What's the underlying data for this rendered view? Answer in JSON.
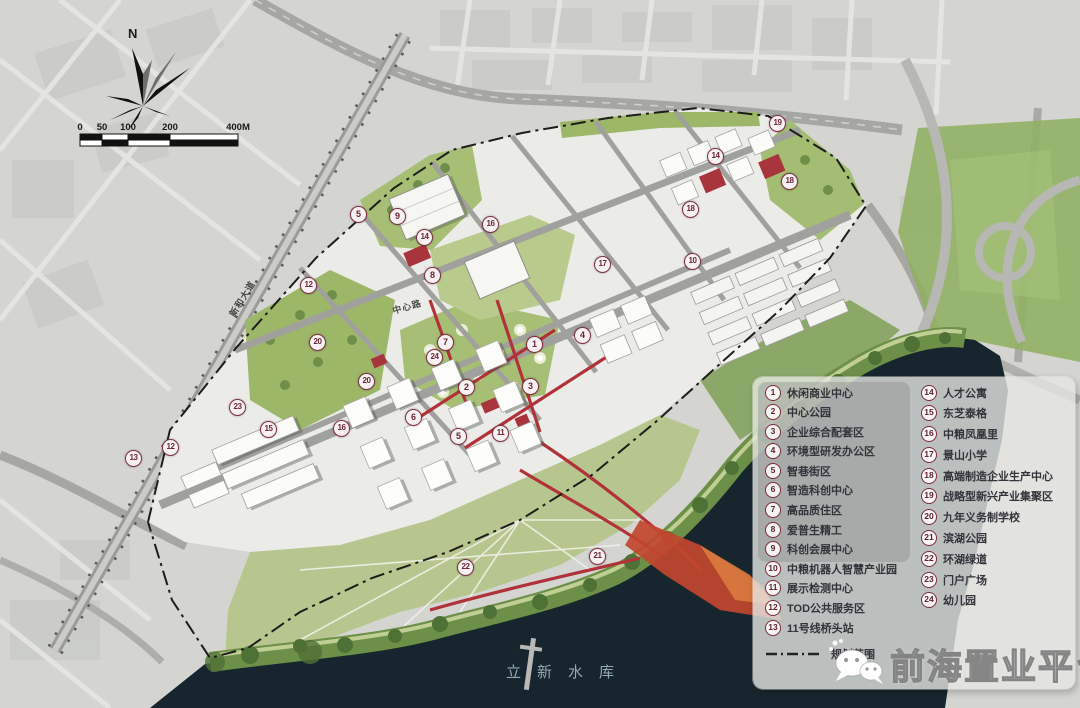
{
  "map": {
    "north_label": "N",
    "scale": {
      "labels": [
        "0",
        "50",
        "100",
        "200",
        "400M"
      ]
    },
    "water_label": "立新水库",
    "road_labels": [
      {
        "text": "新和大道"
      },
      {
        "text": "中心路"
      }
    ],
    "markers": [
      {
        "n": "5",
        "x": 358,
        "y": 214
      },
      {
        "n": "9",
        "x": 397,
        "y": 216
      },
      {
        "n": "14",
        "x": 424,
        "y": 237
      },
      {
        "n": "16",
        "x": 490,
        "y": 224
      },
      {
        "n": "8",
        "x": 432,
        "y": 275
      },
      {
        "n": "12",
        "x": 308,
        "y": 285
      },
      {
        "n": "20",
        "x": 317,
        "y": 342
      },
      {
        "n": "17",
        "x": 602,
        "y": 264
      },
      {
        "n": "18",
        "x": 690,
        "y": 209
      },
      {
        "n": "10",
        "x": 692,
        "y": 261
      },
      {
        "n": "14",
        "x": 715,
        "y": 156
      },
      {
        "n": "19",
        "x": 777,
        "y": 123
      },
      {
        "n": "18",
        "x": 789,
        "y": 181
      },
      {
        "n": "7",
        "x": 445,
        "y": 342
      },
      {
        "n": "24",
        "x": 434,
        "y": 357
      },
      {
        "n": "1",
        "x": 534,
        "y": 344
      },
      {
        "n": "4",
        "x": 582,
        "y": 335
      },
      {
        "n": "2",
        "x": 466,
        "y": 387
      },
      {
        "n": "3",
        "x": 530,
        "y": 386
      },
      {
        "n": "20",
        "x": 366,
        "y": 381
      },
      {
        "n": "6",
        "x": 413,
        "y": 417
      },
      {
        "n": "5",
        "x": 458,
        "y": 436
      },
      {
        "n": "11",
        "x": 500,
        "y": 433
      },
      {
        "n": "23",
        "x": 237,
        "y": 407
      },
      {
        "n": "15",
        "x": 268,
        "y": 429
      },
      {
        "n": "16",
        "x": 341,
        "y": 428
      },
      {
        "n": "12",
        "x": 170,
        "y": 447
      },
      {
        "n": "13",
        "x": 133,
        "y": 458
      },
      {
        "n": "21",
        "x": 597,
        "y": 556
      },
      {
        "n": "22",
        "x": 465,
        "y": 567
      }
    ]
  },
  "legend": {
    "items_left": [
      {
        "n": "1",
        "label": "休闲商业中心"
      },
      {
        "n": "2",
        "label": "中心公园"
      },
      {
        "n": "3",
        "label": "企业综合配套区"
      },
      {
        "n": "4",
        "label": "环境型研发办公区"
      },
      {
        "n": "5",
        "label": "智巷街区"
      },
      {
        "n": "6",
        "label": "智造科创中心"
      },
      {
        "n": "7",
        "label": "高品质住区"
      },
      {
        "n": "8",
        "label": "爱普生精工"
      },
      {
        "n": "9",
        "label": "科创会展中心"
      },
      {
        "n": "10",
        "label": "中粮机器人智慧产业园"
      },
      {
        "n": "11",
        "label": "展示检测中心"
      },
      {
        "n": "12",
        "label": "TOD公共服务区"
      },
      {
        "n": "13",
        "label": "11号线桥头站"
      }
    ],
    "items_right": [
      {
        "n": "14",
        "label": "人才公寓"
      },
      {
        "n": "15",
        "label": "东芝泰格"
      },
      {
        "n": "16",
        "label": "中粮凤凰里"
      },
      {
        "n": "17",
        "label": "景山小学"
      },
      {
        "n": "18",
        "label": "高端制造企业生产中心"
      },
      {
        "n": "19",
        "label": "战略型新兴产业集聚区"
      },
      {
        "n": "20",
        "label": "九年义务制学校"
      },
      {
        "n": "21",
        "label": "滨湖公园"
      },
      {
        "n": "22",
        "label": "环湖绿道"
      },
      {
        "n": "23",
        "label": "门户广场"
      },
      {
        "n": "24",
        "label": "幼儿园"
      }
    ],
    "boundary_label": "规划范围"
  },
  "watermark": {
    "text": "前海置业平台",
    "icon": "wechat-icon"
  },
  "colors": {
    "city": "#d4d5d1",
    "water": "#17262e",
    "site": "#ebebe7",
    "park_green": "#a7bf74",
    "shore_green": "#6d9048",
    "accent_red": "#b13238",
    "marker_ring": "#823041",
    "legend_bg": "rgba(229,230,226,0.80)"
  }
}
